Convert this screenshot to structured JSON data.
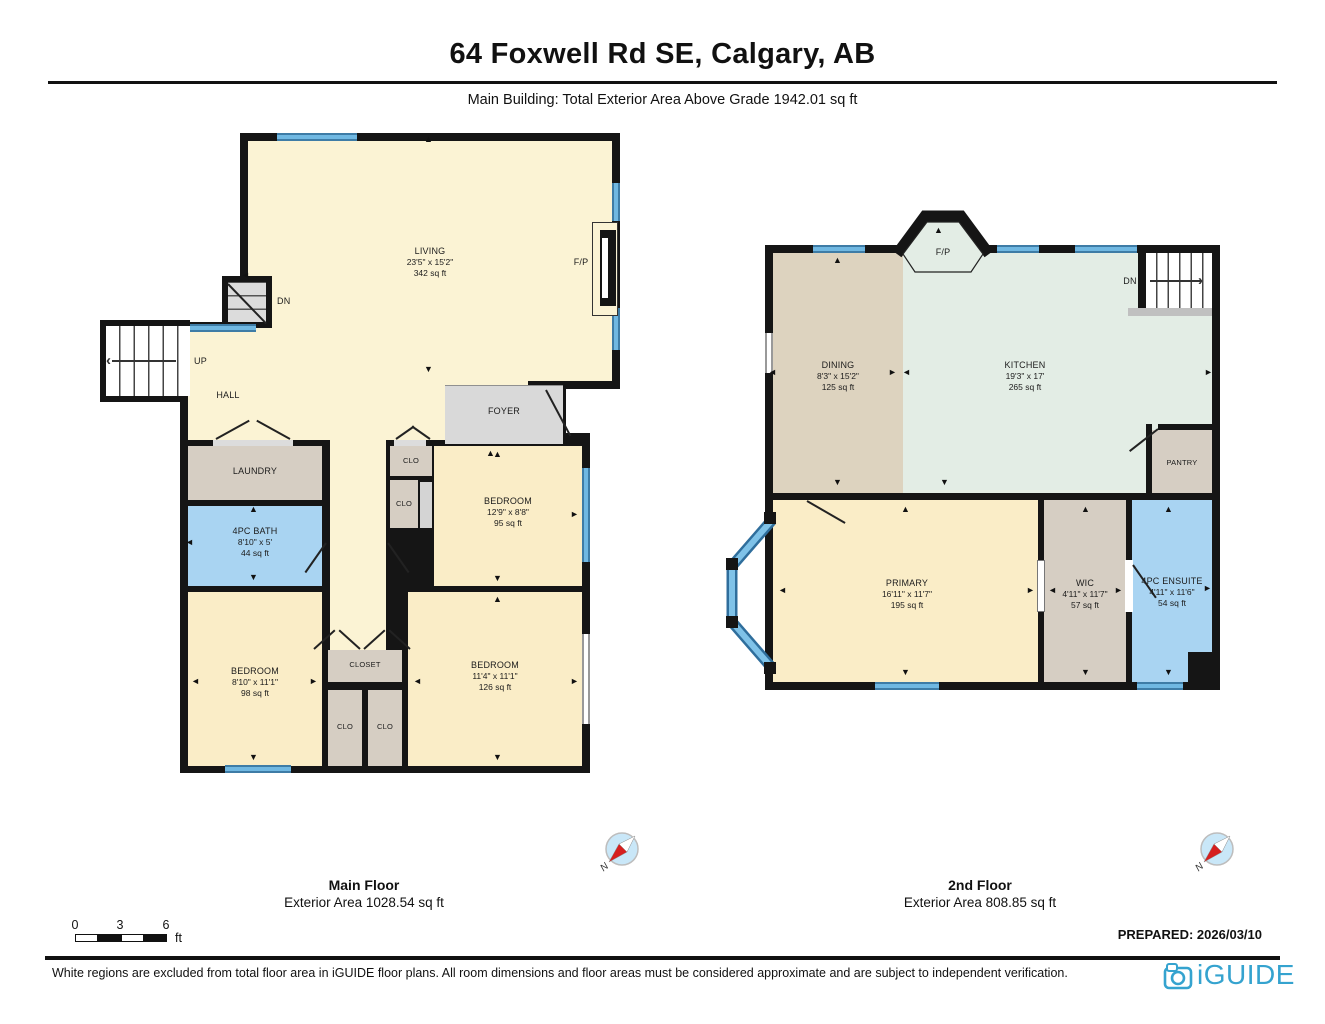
{
  "header": {
    "title": "64 Foxwell Rd SE, Calgary, AB",
    "subtitle": "Main Building: Total Exterior Area Above Grade 1942.01 sq ft"
  },
  "glyphs": {
    "up": "▲",
    "down": "▼",
    "left": "◄",
    "right": "►",
    "chevron_left": "‹",
    "chevron_right": "›"
  },
  "main_floor": {
    "floor_label": "Main Floor",
    "area_label": "Exterior Area 1028.54 sq ft",
    "compass_label": "N",
    "rooms": {
      "living": {
        "name": "LIVING",
        "dim": "23'5\" x 15'2\"",
        "area": "342 sq ft"
      },
      "foyer": {
        "name": "FOYER"
      },
      "hall": {
        "name": "HALL"
      },
      "laundry": {
        "name": "LAUNDRY"
      },
      "bath": {
        "name": "4PC BATH",
        "dim": "8'10\" x 5'",
        "area": "44 sq ft"
      },
      "bedroom_left": {
        "name": "BEDROOM",
        "dim": "8'10\" x 11'1\"",
        "area": "98 sq ft"
      },
      "bedroom_top": {
        "name": "BEDROOM",
        "dim": "12'9\" x 8'8\"",
        "area": "95 sq ft"
      },
      "bedroom_right": {
        "name": "BEDROOM",
        "dim": "11'4\" x 11'1\"",
        "area": "126 sq ft"
      },
      "closet": {
        "name": "CLOSET"
      }
    },
    "clo_labels": [
      "CLO",
      "CLO",
      "CLO",
      "CLO"
    ],
    "stairs": {
      "up": "UP",
      "dn": "DN"
    },
    "fireplace": "F/P"
  },
  "second_floor": {
    "floor_label": "2nd Floor",
    "area_label": "Exterior Area 808.85 sq ft",
    "compass_label": "N",
    "rooms": {
      "dining": {
        "name": "DINING",
        "dim": "8'3\" x 15'2\"",
        "area": "125 sq ft"
      },
      "kitchen": {
        "name": "KITCHEN",
        "dim": "19'3\" x 17'",
        "area": "265 sq ft"
      },
      "pantry": {
        "name": "PANTRY"
      },
      "primary": {
        "name": "PRIMARY",
        "dim": "16'11\" x 11'7\"",
        "area": "195 sq ft"
      },
      "wic": {
        "name": "WIC",
        "dim": "4'11\" x 11'7\"",
        "area": "57 sq ft"
      },
      "ensuite": {
        "name": "4PC ENSUITE",
        "dim": "4'11\" x 11'6\"",
        "area": "54 sq ft"
      }
    },
    "stairs": {
      "dn": "DN"
    },
    "fireplace": "F/P"
  },
  "scale_bar": {
    "ticks": [
      "0",
      "3",
      "6"
    ],
    "unit": "ft"
  },
  "prepared_label": "PREPARED: 2026/03/10",
  "footer": {
    "disclaimer": "White regions are excluded from total floor area in iGUIDE floor plans. All room dimensions and floor areas must be considered approximate and are subject to independent verification.",
    "brand": "iGUIDE"
  },
  "colors": {
    "wall": "#151515",
    "window_blue": "#70B8E2",
    "window_edge": "#3E7CA6",
    "room_cream": "#FBF3D4",
    "room_cream_dark": "#FAEDC7",
    "room_tan": "#D6CEC3",
    "room_dining": "#DDD3BF",
    "room_kitchen": "#E3EDE5",
    "room_bath_blue": "#A9D4F2",
    "room_gray": "#D9D9D9",
    "compass_red": "#D61F1F",
    "brand_blue": "#35A3CF"
  }
}
